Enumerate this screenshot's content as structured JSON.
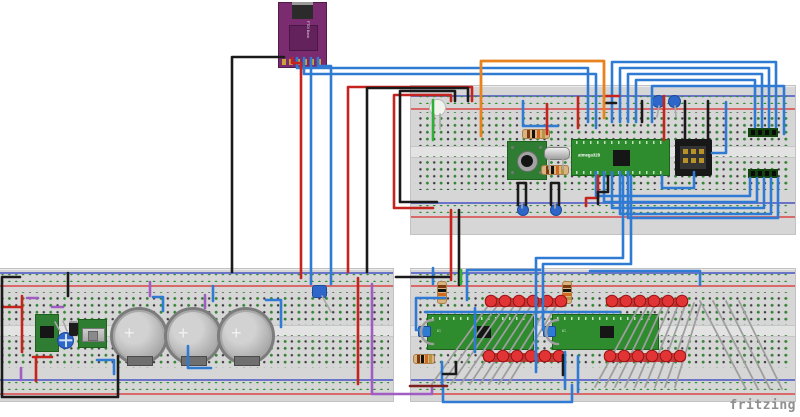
{
  "watermark": "fritzing",
  "ftdi": {
    "label": "FTDI Basic"
  },
  "mcu": {
    "label": "atmega328"
  },
  "ic1": {
    "label": "IC"
  },
  "ic2": {
    "label": "IC"
  },
  "battery": {
    "count": 3,
    "plus": "+"
  },
  "palette": {
    "blue": "#2f7bd4",
    "red": "#c5231d",
    "darkred": "#7e2020",
    "black": "#1a1a1a",
    "orange": "#e8821e",
    "purple": "#a05cc2",
    "green": "#2fae38",
    "gray": "#9e9e9e",
    "board_green": "#2e8b2e",
    "body_purple": "#7b2c71"
  },
  "parts": [
    {
      "name": "breadboard-top-right"
    },
    {
      "name": "breadboard-bottom-left"
    },
    {
      "name": "breadboard-bottom-right"
    },
    {
      "name": "ftdi-breakout"
    },
    {
      "name": "atmega328-breakout"
    },
    {
      "name": "icsp-header"
    },
    {
      "name": "tactile-button-board"
    },
    {
      "name": "crystal-oscillator"
    },
    {
      "name": "white-led"
    },
    {
      "name": "resistor",
      "count": 4
    },
    {
      "name": "coin-cell-battery",
      "count": 3
    },
    {
      "name": "dip-ic",
      "count": 2
    },
    {
      "name": "led-strip",
      "count": 4
    },
    {
      "name": "voltage-regulator-board"
    },
    {
      "name": "slide-switch-board"
    },
    {
      "name": "trimmer-capacitor",
      "count": 2
    },
    {
      "name": "ceramic-capacitor",
      "count": 4
    },
    {
      "name": "pin-header-4",
      "count": 2
    }
  ],
  "led_strips": [
    {
      "x": 491,
      "y": 301,
      "count": 6,
      "pitch": 14
    },
    {
      "x": 489,
      "y": 356,
      "count": 6,
      "pitch": 14
    },
    {
      "x": 612,
      "y": 301,
      "count": 6,
      "pitch": 14
    },
    {
      "x": 610,
      "y": 356,
      "count": 6,
      "pitch": 14
    }
  ],
  "fans": [
    [
      432,
      384,
      490,
      303
    ],
    [
      442,
      384,
      499,
      303
    ],
    [
      451,
      384,
      507,
      303
    ],
    [
      461,
      384,
      516,
      303
    ],
    [
      470,
      384,
      524,
      303
    ],
    [
      480,
      384,
      533,
      303
    ],
    [
      489,
      384,
      541,
      303
    ],
    [
      499,
      384,
      550,
      303
    ],
    [
      508,
      384,
      558,
      303
    ],
    [
      595,
      387,
      641,
      303
    ],
    [
      605,
      387,
      649,
      303
    ],
    [
      615,
      387,
      656,
      303
    ],
    [
      625,
      387,
      664,
      303
    ],
    [
      635,
      387,
      671,
      303
    ],
    [
      645,
      387,
      679,
      303
    ],
    [
      655,
      387,
      686,
      303
    ],
    [
      665,
      387,
      694,
      303
    ],
    [
      675,
      387,
      701,
      303
    ],
    [
      700,
      301,
      746,
      389
    ],
    [
      713,
      301,
      758,
      389
    ],
    [
      726,
      301,
      770,
      389
    ],
    [
      739,
      301,
      782,
      389
    ]
  ],
  "gray_leads": [
    [
      434,
      114,
      434,
      129
    ],
    [
      440,
      114,
      440,
      129
    ],
    [
      549,
      158,
      549,
      169
    ],
    [
      563,
      158,
      563,
      169
    ],
    [
      659,
      106,
      657,
      117
    ],
    [
      675,
      106,
      676,
      117
    ],
    [
      60,
      331,
      55,
      322
    ],
    [
      67,
      331,
      63,
      321
    ],
    [
      322,
      296,
      331,
      312
    ],
    [
      522,
      203,
      522,
      208
    ],
    [
      555,
      203,
      555,
      208
    ]
  ],
  "wires": [
    {
      "c": "blue",
      "d": "M297,58 V68 H588 V122"
    },
    {
      "c": "blue",
      "d": "M304,58 V74 H596 V128"
    },
    {
      "c": "blue",
      "d": "M311,58 V284"
    },
    {
      "c": "blue",
      "d": "M318,58 V66 H331 V284"
    },
    {
      "c": "blue",
      "d": "M523,101 V126 H558"
    },
    {
      "c": "blue",
      "d": "M612,122 V62 H776 V127"
    },
    {
      "c": "blue",
      "d": "M620,122 V68 H769 V127"
    },
    {
      "c": "blue",
      "d": "M628,122 V74 H762 V127"
    },
    {
      "c": "blue",
      "d": "M636,122 V80 H755 V127"
    },
    {
      "c": "blue",
      "d": "M652,122 V86 H784 V134"
    },
    {
      "c": "blue",
      "d": "M596,172 V196 H750 V178"
    },
    {
      "c": "blue",
      "d": "M604,172 V202 H757 V178"
    },
    {
      "c": "blue",
      "d": "M612,172 V208 H764 V178"
    },
    {
      "c": "blue",
      "d": "M620,172 V214 H771 V178"
    },
    {
      "c": "blue",
      "d": "M628,172 V218 H778 V178"
    },
    {
      "c": "blue",
      "d": "M712,153 H726 V102"
    },
    {
      "c": "blue",
      "d": "M694,172 V188 H662 V176"
    },
    {
      "c": "blue",
      "d": "M623,176 V258 H536 V372"
    },
    {
      "c": "blue",
      "d": "M631,176 V264 H543 V330"
    },
    {
      "c": "blue",
      "d": "M540,270 H467 V300"
    },
    {
      "c": "blue",
      "d": "M425,312 H620"
    },
    {
      "c": "blue",
      "d": "M445,298 H416 V330 H426"
    },
    {
      "c": "blue",
      "d": "M443,385 V402 H572 V385"
    },
    {
      "c": "blue",
      "d": "M442,362 V385"
    },
    {
      "c": "blue",
      "d": "M475,308 V352"
    },
    {
      "c": "blue",
      "d": "M590,271 H700 V285"
    },
    {
      "c": "blue",
      "d": "M565,352 V388"
    },
    {
      "c": "blue",
      "d": "M578,356 V392"
    },
    {
      "c": "blue",
      "d": "M433,268 V284"
    },
    {
      "c": "blue",
      "d": "M153,297 H163 V311"
    },
    {
      "c": "blue",
      "d": "M97,360 H114 V374"
    },
    {
      "c": "blue",
      "d": "M213,286 V301"
    },
    {
      "c": "blue",
      "d": "M188,346 V368 H211"
    },
    {
      "c": "blue",
      "d": "M266,300 H281 V327"
    },
    {
      "c": "red",
      "d": "M292,58 V63 H301 V278"
    },
    {
      "c": "red",
      "d": "M472,101 V87 H348 V272"
    },
    {
      "c": "red",
      "d": "M451,101 V95 H394 V208 H433"
    },
    {
      "c": "red",
      "d": "M547,104 V134"
    },
    {
      "c": "red",
      "d": "M578,97 V128"
    },
    {
      "c": "red",
      "d": "M664,96 V140"
    },
    {
      "c": "red",
      "d": "M606,96 H619"
    },
    {
      "c": "red",
      "d": "M451,210 V280"
    },
    {
      "c": "red",
      "d": "M358,278 V384"
    },
    {
      "c": "red",
      "d": "M2,307 H22"
    },
    {
      "c": "red",
      "d": "M22,296 V352"
    },
    {
      "c": "red",
      "d": "M33,357 H52"
    },
    {
      "c": "red",
      "d": "M36,357 V381"
    },
    {
      "c": "red",
      "d": "M598,176 V198 H586 V206"
    },
    {
      "c": "black",
      "d": "M284,57 H232 V272"
    },
    {
      "c": "black",
      "d": "M468,101 V88 H367 V272"
    },
    {
      "c": "black",
      "d": "M455,101 V91 H400 V202 H437"
    },
    {
      "c": "black",
      "d": "M642,101 V122"
    },
    {
      "c": "black",
      "d": "M685,101 V140"
    },
    {
      "c": "black",
      "d": "M708,101 V140"
    },
    {
      "c": "black",
      "d": "M518,205 V183 H526 V205"
    },
    {
      "c": "black",
      "d": "M551,205 V183 H559 V205"
    },
    {
      "c": "black",
      "d": "M608,176 V192 H598 V204"
    },
    {
      "c": "black",
      "d": "M459,210 V285"
    },
    {
      "c": "black",
      "d": "M396,277 H449"
    },
    {
      "c": "black",
      "d": "M20,277 H2 V397 H118 V356"
    },
    {
      "c": "black",
      "d": "M68,273 V296"
    },
    {
      "c": "black",
      "d": "M443,374 H456 V362"
    },
    {
      "c": "black",
      "d": "M563,355 V375"
    },
    {
      "c": "black",
      "d": "M606,103 H616"
    },
    {
      "c": "orange",
      "d": "M481,136 V61 H604 V118",
      "w": 2.8
    },
    {
      "c": "purple",
      "d": "M27,298 H38"
    },
    {
      "c": "purple",
      "d": "M52,307 H63"
    },
    {
      "c": "purple",
      "d": "M150,282 V296"
    },
    {
      "c": "purple",
      "d": "M205,295 V308"
    },
    {
      "c": "purple",
      "d": "M21,368 V380"
    },
    {
      "c": "purple",
      "d": "M372,284 V394 H432 V386"
    },
    {
      "c": "green",
      "d": "M433,100 V140"
    },
    {
      "c": "green",
      "d": "M461,270 V284"
    },
    {
      "c": "darkred",
      "d": "M410,386 H447"
    },
    {
      "c": "gray",
      "d": "M433,320 A12,12 0 0 0 433,344",
      "w": 2.5
    },
    {
      "c": "gray",
      "d": "M558,320 A12,12 0 0 0 558,344",
      "w": 2.5
    }
  ]
}
